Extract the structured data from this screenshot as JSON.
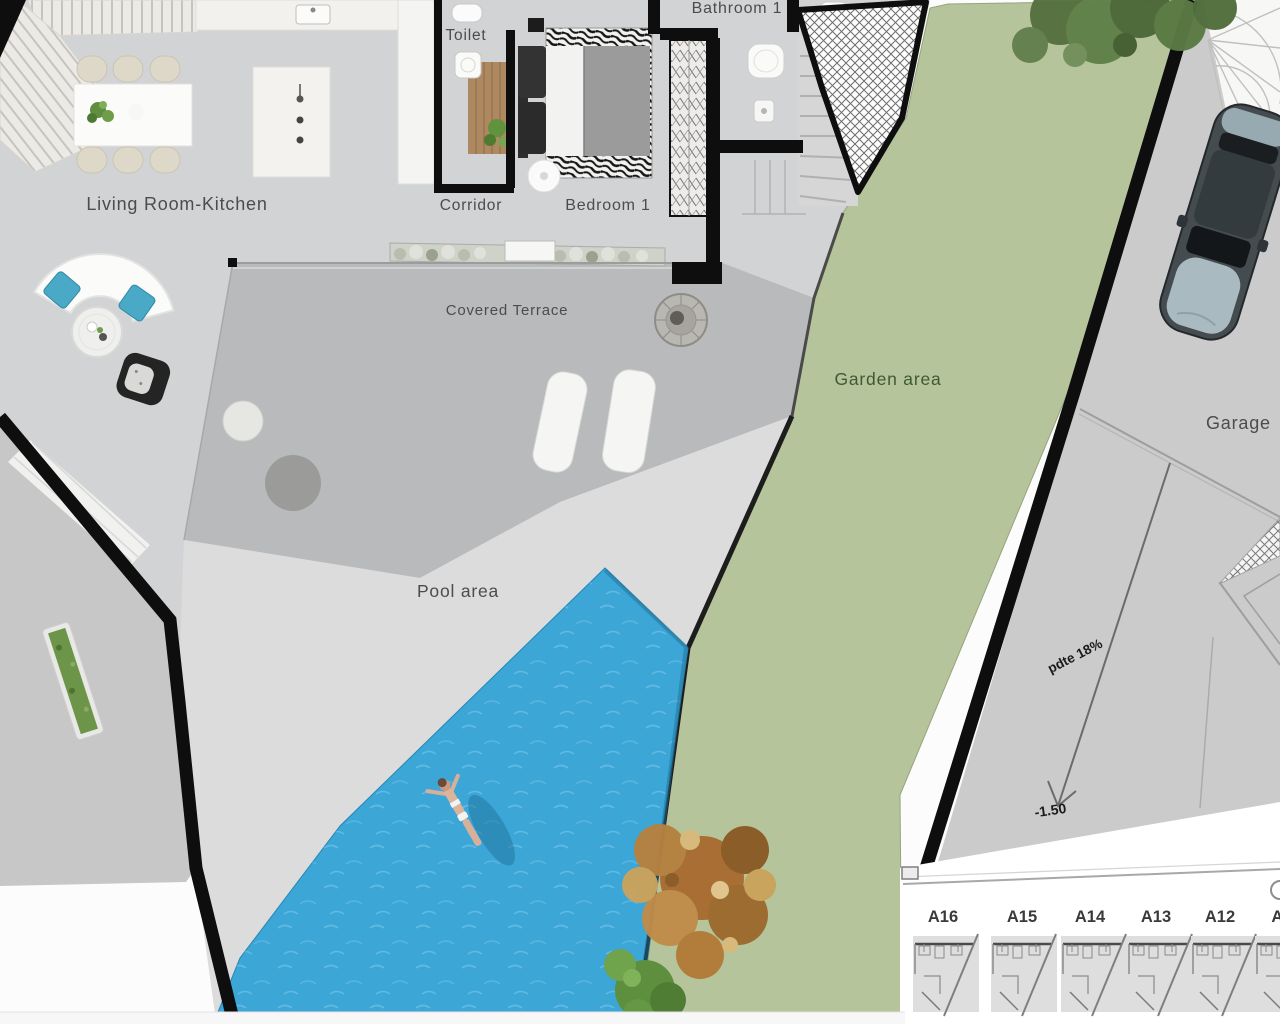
{
  "document": {
    "type": "architectural floor plan",
    "view": "top-down villa ground floor with pool, garden and garage"
  },
  "colors": {
    "floor": "#d2d3d4",
    "terrace": "#b9babc",
    "deck": "#dcdcdc",
    "garden": "#b5c49a",
    "pool": "#3ca6d7",
    "wall": "#0e0e0e",
    "label": "#4c4c4c",
    "garden_label": "#3f5a33"
  },
  "rooms": {
    "living": {
      "label": "Living Room-Kitchen"
    },
    "toilet": {
      "label": "Toilet"
    },
    "corridor": {
      "label": "Corridor"
    },
    "bedroom1": {
      "label": "Bedroom 1"
    },
    "bathroom": {
      "label": "Bathroom 1"
    },
    "terrace": {
      "label": "Covered Terrace"
    },
    "garden": {
      "label": "Garden area"
    },
    "pool": {
      "label": "Pool area"
    },
    "garage": {
      "label": "Garage"
    }
  },
  "annotations": {
    "slope": "pdte 18%",
    "level": "-1.50"
  },
  "units": [
    "A16",
    "A15",
    "A14",
    "A13",
    "A12",
    "A11"
  ]
}
